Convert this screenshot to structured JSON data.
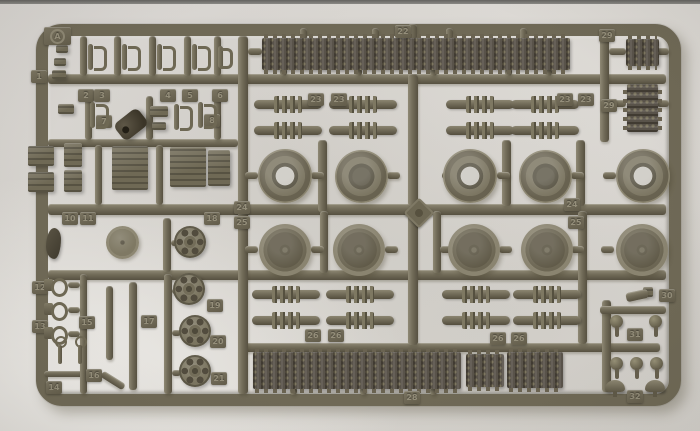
{
  "photo": {
    "width": 700,
    "height": 431,
    "subject": "olive drab plastic model kit sprue with tank tracks, road wheels and sprockets",
    "background_color": "#d7d4cf",
    "top_edge_color": "#63625f",
    "plastic_color": "#6f6956",
    "track_color": "#59534a",
    "tab_text_color": "#948e7a"
  },
  "sprue": {
    "letter": "A",
    "frame": {
      "x": 36,
      "y": 24,
      "w": 645,
      "h": 382,
      "border": 12,
      "radius": 26
    }
  },
  "runners": [
    [
      48,
      74,
      618,
      10
    ],
    [
      48,
      139,
      190,
      8
    ],
    [
      48,
      204,
      618,
      11
    ],
    [
      48,
      270,
      618,
      10
    ],
    [
      240,
      343,
      420,
      9
    ],
    [
      238,
      36,
      10,
      358
    ],
    [
      318,
      140,
      9,
      72
    ],
    [
      320,
      211,
      8,
      62
    ],
    [
      408,
      24,
      9,
      16
    ],
    [
      408,
      74,
      10,
      132
    ],
    [
      408,
      215,
      10,
      130
    ],
    [
      433,
      211,
      8,
      62
    ],
    [
      502,
      140,
      9,
      66
    ],
    [
      576,
      140,
      9,
      66
    ],
    [
      578,
      211,
      9,
      133
    ],
    [
      600,
      36,
      9,
      106
    ],
    [
      602,
      300,
      9,
      92
    ],
    [
      600,
      306,
      66,
      8
    ],
    [
      44,
      371,
      42,
      6
    ],
    [
      80,
      274,
      7,
      120
    ],
    [
      164,
      274,
      8,
      120
    ],
    [
      163,
      218,
      8,
      54
    ],
    [
      80,
      36,
      7,
      40
    ],
    [
      114,
      36,
      7,
      40
    ],
    [
      149,
      36,
      7,
      40
    ],
    [
      184,
      36,
      7,
      40
    ],
    [
      214,
      36,
      7,
      40
    ],
    [
      85,
      96,
      7,
      44
    ],
    [
      146,
      96,
      7,
      44
    ],
    [
      214,
      96,
      7,
      44
    ],
    [
      95,
      145,
      7,
      60
    ],
    [
      156,
      145,
      7,
      60
    ],
    [
      245,
      172,
      13,
      7
    ],
    [
      311,
      172,
      13,
      7
    ],
    [
      387,
      172,
      13,
      7
    ],
    [
      442,
      172,
      13,
      7
    ],
    [
      497,
      172,
      13,
      7
    ],
    [
      571,
      172,
      13,
      7
    ],
    [
      603,
      172,
      13,
      7
    ],
    [
      245,
      246,
      13,
      7
    ],
    [
      311,
      246,
      13,
      7
    ],
    [
      385,
      246,
      13,
      7
    ],
    [
      440,
      246,
      13,
      7
    ],
    [
      499,
      246,
      13,
      7
    ],
    [
      571,
      246,
      13,
      7
    ],
    [
      601,
      246,
      13,
      7
    ],
    [
      300,
      28,
      7,
      12
    ],
    [
      372,
      28,
      7,
      12
    ],
    [
      446,
      28,
      7,
      12
    ],
    [
      520,
      28,
      7,
      12
    ],
    [
      280,
      68,
      7,
      8
    ],
    [
      355,
      68,
      7,
      8
    ],
    [
      430,
      68,
      7,
      8
    ],
    [
      505,
      68,
      7,
      8
    ],
    [
      545,
      68,
      7,
      8
    ],
    [
      290,
      387,
      7,
      8
    ],
    [
      360,
      387,
      7,
      8
    ],
    [
      430,
      387,
      7,
      8
    ],
    [
      609,
      48,
      17,
      7
    ],
    [
      609,
      100,
      17,
      7
    ],
    [
      657,
      48,
      12,
      7
    ],
    [
      657,
      100,
      12,
      7
    ],
    [
      68,
      282,
      12,
      6
    ],
    [
      68,
      307,
      12,
      6
    ],
    [
      68,
      331,
      12,
      6
    ],
    [
      171,
      240,
      9,
      6
    ],
    [
      172,
      288,
      9,
      6
    ],
    [
      172,
      330,
      9,
      6
    ],
    [
      172,
      370,
      9,
      6
    ],
    [
      248,
      48,
      14,
      7
    ]
  ],
  "parts": [
    {
      "t": "track",
      "x": 262,
      "y": 38,
      "w": 308,
      "h": 32
    },
    {
      "t": "track",
      "x": 253,
      "y": 352,
      "w": 208,
      "h": 37
    },
    {
      "t": "track",
      "x": 466,
      "y": 354,
      "w": 38,
      "h": 33
    },
    {
      "t": "track",
      "x": 507,
      "y": 352,
      "w": 56,
      "h": 36
    },
    {
      "t": "track",
      "x": 626,
      "y": 39,
      "w": 33,
      "h": 27
    },
    {
      "t": "trackv",
      "x": 627,
      "y": 84,
      "w": 31,
      "h": 48
    },
    {
      "t": "wheelA",
      "x": 258,
      "y": 149,
      "w": 54,
      "h": 54,
      "hl": "#cac7c0"
    },
    {
      "t": "wheelA",
      "x": 335,
      "y": 150,
      "w": 53,
      "h": 53,
      "hl": "#5e5949"
    },
    {
      "t": "wheelA",
      "x": 443,
      "y": 149,
      "w": 54,
      "h": 54,
      "hl": "#cac7c0"
    },
    {
      "t": "wheelA",
      "x": 519,
      "y": 150,
      "w": 53,
      "h": 53,
      "hl": "#5e5949"
    },
    {
      "t": "wheelA",
      "x": 616,
      "y": 149,
      "w": 54,
      "h": 54,
      "hl": "#cac7c0"
    },
    {
      "t": "wheelB",
      "x": 259,
      "y": 224,
      "w": 52,
      "h": 52
    },
    {
      "t": "wheelB",
      "x": 333,
      "y": 224,
      "w": 52,
      "h": 52
    },
    {
      "t": "wheelB",
      "x": 448,
      "y": 224,
      "w": 52,
      "h": 52
    },
    {
      "t": "wheelB",
      "x": 521,
      "y": 224,
      "w": 52,
      "h": 52
    },
    {
      "t": "wheelB",
      "x": 616,
      "y": 224,
      "w": 52,
      "h": 52
    },
    {
      "t": "sprocket",
      "x": 174,
      "y": 226,
      "w": 32,
      "h": 32
    },
    {
      "t": "sprocket",
      "x": 173,
      "y": 273,
      "w": 32,
      "h": 32
    },
    {
      "t": "sprocket",
      "x": 179,
      "y": 315,
      "w": 32,
      "h": 32
    },
    {
      "t": "sprocket",
      "x": 179,
      "y": 355,
      "w": 32,
      "h": 32
    },
    {
      "t": "drum",
      "x": 106,
      "y": 226,
      "w": 33,
      "h": 33
    },
    {
      "t": "arm",
      "x": 254,
      "y": 100,
      "w": 68
    },
    {
      "t": "arm",
      "x": 329,
      "y": 100,
      "w": 68
    },
    {
      "t": "arm",
      "x": 446,
      "y": 100,
      "w": 68
    },
    {
      "t": "arm",
      "x": 511,
      "y": 100,
      "w": 68
    },
    {
      "t": "arm",
      "x": 254,
      "y": 126,
      "w": 68
    },
    {
      "t": "arm",
      "x": 329,
      "y": 126,
      "w": 68
    },
    {
      "t": "arm",
      "x": 446,
      "y": 126,
      "w": 68
    },
    {
      "t": "arm",
      "x": 511,
      "y": 126,
      "w": 68
    },
    {
      "t": "arm",
      "x": 252,
      "y": 290,
      "w": 68
    },
    {
      "t": "arm",
      "x": 326,
      "y": 290,
      "w": 68
    },
    {
      "t": "arm",
      "x": 442,
      "y": 290,
      "w": 68
    },
    {
      "t": "arm",
      "x": 513,
      "y": 290,
      "w": 68
    },
    {
      "t": "arm",
      "x": 252,
      "y": 316,
      "w": 68
    },
    {
      "t": "arm",
      "x": 326,
      "y": 316,
      "w": 68
    },
    {
      "t": "arm",
      "x": 442,
      "y": 316,
      "w": 68
    },
    {
      "t": "arm",
      "x": 513,
      "y": 316,
      "w": 68
    },
    {
      "t": "atab",
      "x": 44,
      "y": 27,
      "l": "A"
    },
    {
      "t": "tab",
      "x": 31,
      "y": 70,
      "l": "1"
    },
    {
      "t": "tab",
      "x": 78,
      "y": 89,
      "l": "2"
    },
    {
      "t": "tab",
      "x": 94,
      "y": 89,
      "l": "3"
    },
    {
      "t": "tab",
      "x": 160,
      "y": 89,
      "l": "4"
    },
    {
      "t": "tab",
      "x": 182,
      "y": 89,
      "l": "5"
    },
    {
      "t": "tab",
      "x": 212,
      "y": 89,
      "l": "6"
    },
    {
      "t": "tab",
      "x": 96,
      "y": 115,
      "l": "7"
    },
    {
      "t": "tab",
      "x": 204,
      "y": 114,
      "l": "8"
    },
    {
      "t": "tab",
      "x": 214,
      "y": 170,
      "l": "9"
    },
    {
      "t": "tab",
      "x": 62,
      "y": 212,
      "l": "10"
    },
    {
      "t": "tab",
      "x": 80,
      "y": 212,
      "l": "11"
    },
    {
      "t": "tab",
      "x": 204,
      "y": 212,
      "l": "18"
    },
    {
      "t": "tab",
      "x": 32,
      "y": 281,
      "l": "12"
    },
    {
      "t": "tab",
      "x": 32,
      "y": 320,
      "l": "13"
    },
    {
      "t": "tab",
      "x": 46,
      "y": 381,
      "l": "14"
    },
    {
      "t": "tab",
      "x": 79,
      "y": 316,
      "l": "15"
    },
    {
      "t": "tab",
      "x": 86,
      "y": 369,
      "l": "16"
    },
    {
      "t": "tab",
      "x": 141,
      "y": 315,
      "l": "17"
    },
    {
      "t": "tab",
      "x": 207,
      "y": 299,
      "l": "19"
    },
    {
      "t": "tab",
      "x": 210,
      "y": 335,
      "l": "20"
    },
    {
      "t": "tab",
      "x": 211,
      "y": 372,
      "l": "21"
    },
    {
      "t": "tab",
      "x": 395,
      "y": 25,
      "l": "22"
    },
    {
      "t": "tab",
      "x": 308,
      "y": 93,
      "l": "23"
    },
    {
      "t": "tab",
      "x": 331,
      "y": 93,
      "l": "23"
    },
    {
      "t": "tab",
      "x": 557,
      "y": 93,
      "l": "23"
    },
    {
      "t": "tab",
      "x": 578,
      "y": 93,
      "l": "23"
    },
    {
      "t": "tab",
      "x": 234,
      "y": 201,
      "l": "24"
    },
    {
      "t": "tab",
      "x": 564,
      "y": 198,
      "l": "24"
    },
    {
      "t": "tab",
      "x": 234,
      "y": 216,
      "l": "25"
    },
    {
      "t": "tab",
      "x": 568,
      "y": 216,
      "l": "25"
    },
    {
      "t": "tab",
      "x": 305,
      "y": 329,
      "l": "26"
    },
    {
      "t": "tab",
      "x": 328,
      "y": 329,
      "l": "26"
    },
    {
      "t": "tab",
      "x": 490,
      "y": 332,
      "l": "26"
    },
    {
      "t": "tab",
      "x": 511,
      "y": 332,
      "l": "26"
    },
    {
      "t": "tab",
      "x": 404,
      "y": 391,
      "l": "28"
    },
    {
      "t": "tab",
      "x": 599,
      "y": 29,
      "l": "29"
    },
    {
      "t": "tab",
      "x": 601,
      "y": 99,
      "l": "29"
    },
    {
      "t": "tab",
      "x": 659,
      "y": 289,
      "l": "30"
    },
    {
      "t": "tab",
      "x": 627,
      "y": 328,
      "l": "31"
    },
    {
      "t": "tab",
      "x": 627,
      "y": 390,
      "l": "32"
    },
    {
      "t": "clip",
      "x": 86,
      "y": 42,
      "w": 22,
      "h": 30
    },
    {
      "t": "clip",
      "x": 120,
      "y": 42,
      "w": 22,
      "h": 30
    },
    {
      "t": "clip",
      "x": 155,
      "y": 42,
      "w": 22,
      "h": 30
    },
    {
      "t": "clip",
      "x": 190,
      "y": 42,
      "w": 22,
      "h": 30
    },
    {
      "t": "clip",
      "x": 216,
      "y": 44,
      "w": 18,
      "h": 26
    },
    {
      "t": "clip",
      "x": 88,
      "y": 100,
      "w": 22,
      "h": 30
    },
    {
      "t": "clip",
      "x": 172,
      "y": 102,
      "w": 22,
      "h": 30
    },
    {
      "t": "clip",
      "x": 196,
      "y": 100,
      "w": 22,
      "h": 30
    },
    {
      "t": "box",
      "x": 56,
      "y": 45,
      "w": 12,
      "h": 8
    },
    {
      "t": "box",
      "x": 54,
      "y": 58,
      "w": 12,
      "h": 8
    },
    {
      "t": "box",
      "x": 52,
      "y": 70,
      "w": 14,
      "h": 9
    },
    {
      "t": "box",
      "x": 58,
      "y": 104,
      "w": 16,
      "h": 10
    },
    {
      "t": "box",
      "x": 150,
      "y": 106,
      "w": 18,
      "h": 11
    },
    {
      "t": "box",
      "x": 152,
      "y": 122,
      "w": 14,
      "h": 8
    },
    {
      "t": "box",
      "x": 28,
      "y": 146,
      "w": 26,
      "h": 20
    },
    {
      "t": "box",
      "x": 28,
      "y": 172,
      "w": 26,
      "h": 20
    },
    {
      "t": "box",
      "x": 64,
      "y": 143,
      "w": 18,
      "h": 24
    },
    {
      "t": "box",
      "x": 64,
      "y": 170,
      "w": 18,
      "h": 22
    },
    {
      "t": "box",
      "x": 112,
      "y": 146,
      "w": 36,
      "h": 44
    },
    {
      "t": "box",
      "x": 170,
      "y": 147,
      "w": 36,
      "h": 40
    },
    {
      "t": "box",
      "x": 208,
      "y": 150,
      "w": 22,
      "h": 36
    },
    {
      "t": "box",
      "x": 643,
      "y": 287,
      "w": 10,
      "h": 10
    },
    {
      "t": "muffler",
      "x": 116,
      "y": 114,
      "w": 30,
      "h": 21,
      "r": -38
    },
    {
      "t": "fender",
      "x": 46,
      "y": 228,
      "w": 15,
      "h": 31
    },
    {
      "t": "diamond",
      "x": 408,
      "y": 202,
      "w": 18,
      "h": 18,
      "r": 45
    },
    {
      "t": "hook",
      "x": 44,
      "y": 276,
      "w": 26,
      "h": 20
    },
    {
      "t": "hook",
      "x": 44,
      "y": 300,
      "w": 26,
      "h": 20
    },
    {
      "t": "hook",
      "x": 44,
      "y": 324,
      "w": 26,
      "h": 20
    },
    {
      "t": "pin",
      "x": 54,
      "y": 336,
      "w": 11,
      "h": 28
    },
    {
      "t": "pin",
      "x": 74,
      "y": 336,
      "w": 11,
      "h": 28
    },
    {
      "t": "sbar",
      "x": 106,
      "y": 286,
      "w": 7,
      "h": 74
    },
    {
      "t": "sbar",
      "x": 129,
      "y": 282,
      "w": 8,
      "h": 108
    },
    {
      "t": "sbar",
      "x": 100,
      "y": 377,
      "w": 26,
      "h": 7,
      "r": 32
    },
    {
      "t": "sbar",
      "x": 626,
      "y": 291,
      "w": 22,
      "h": 9,
      "r": -12
    },
    {
      "t": "ball",
      "x": 610,
      "y": 315,
      "w": 13,
      "h": 13
    },
    {
      "t": "ball",
      "x": 649,
      "y": 315,
      "w": 13,
      "h": 13
    },
    {
      "t": "ball",
      "x": 610,
      "y": 357,
      "w": 13,
      "h": 13
    },
    {
      "t": "ball",
      "x": 630,
      "y": 357,
      "w": 13,
      "h": 13
    },
    {
      "t": "ball",
      "x": 650,
      "y": 357,
      "w": 13,
      "h": 13
    },
    {
      "t": "mush",
      "x": 605,
      "y": 380,
      "w": 20,
      "h": 12
    },
    {
      "t": "mush",
      "x": 645,
      "y": 380,
      "w": 20,
      "h": 12
    }
  ]
}
